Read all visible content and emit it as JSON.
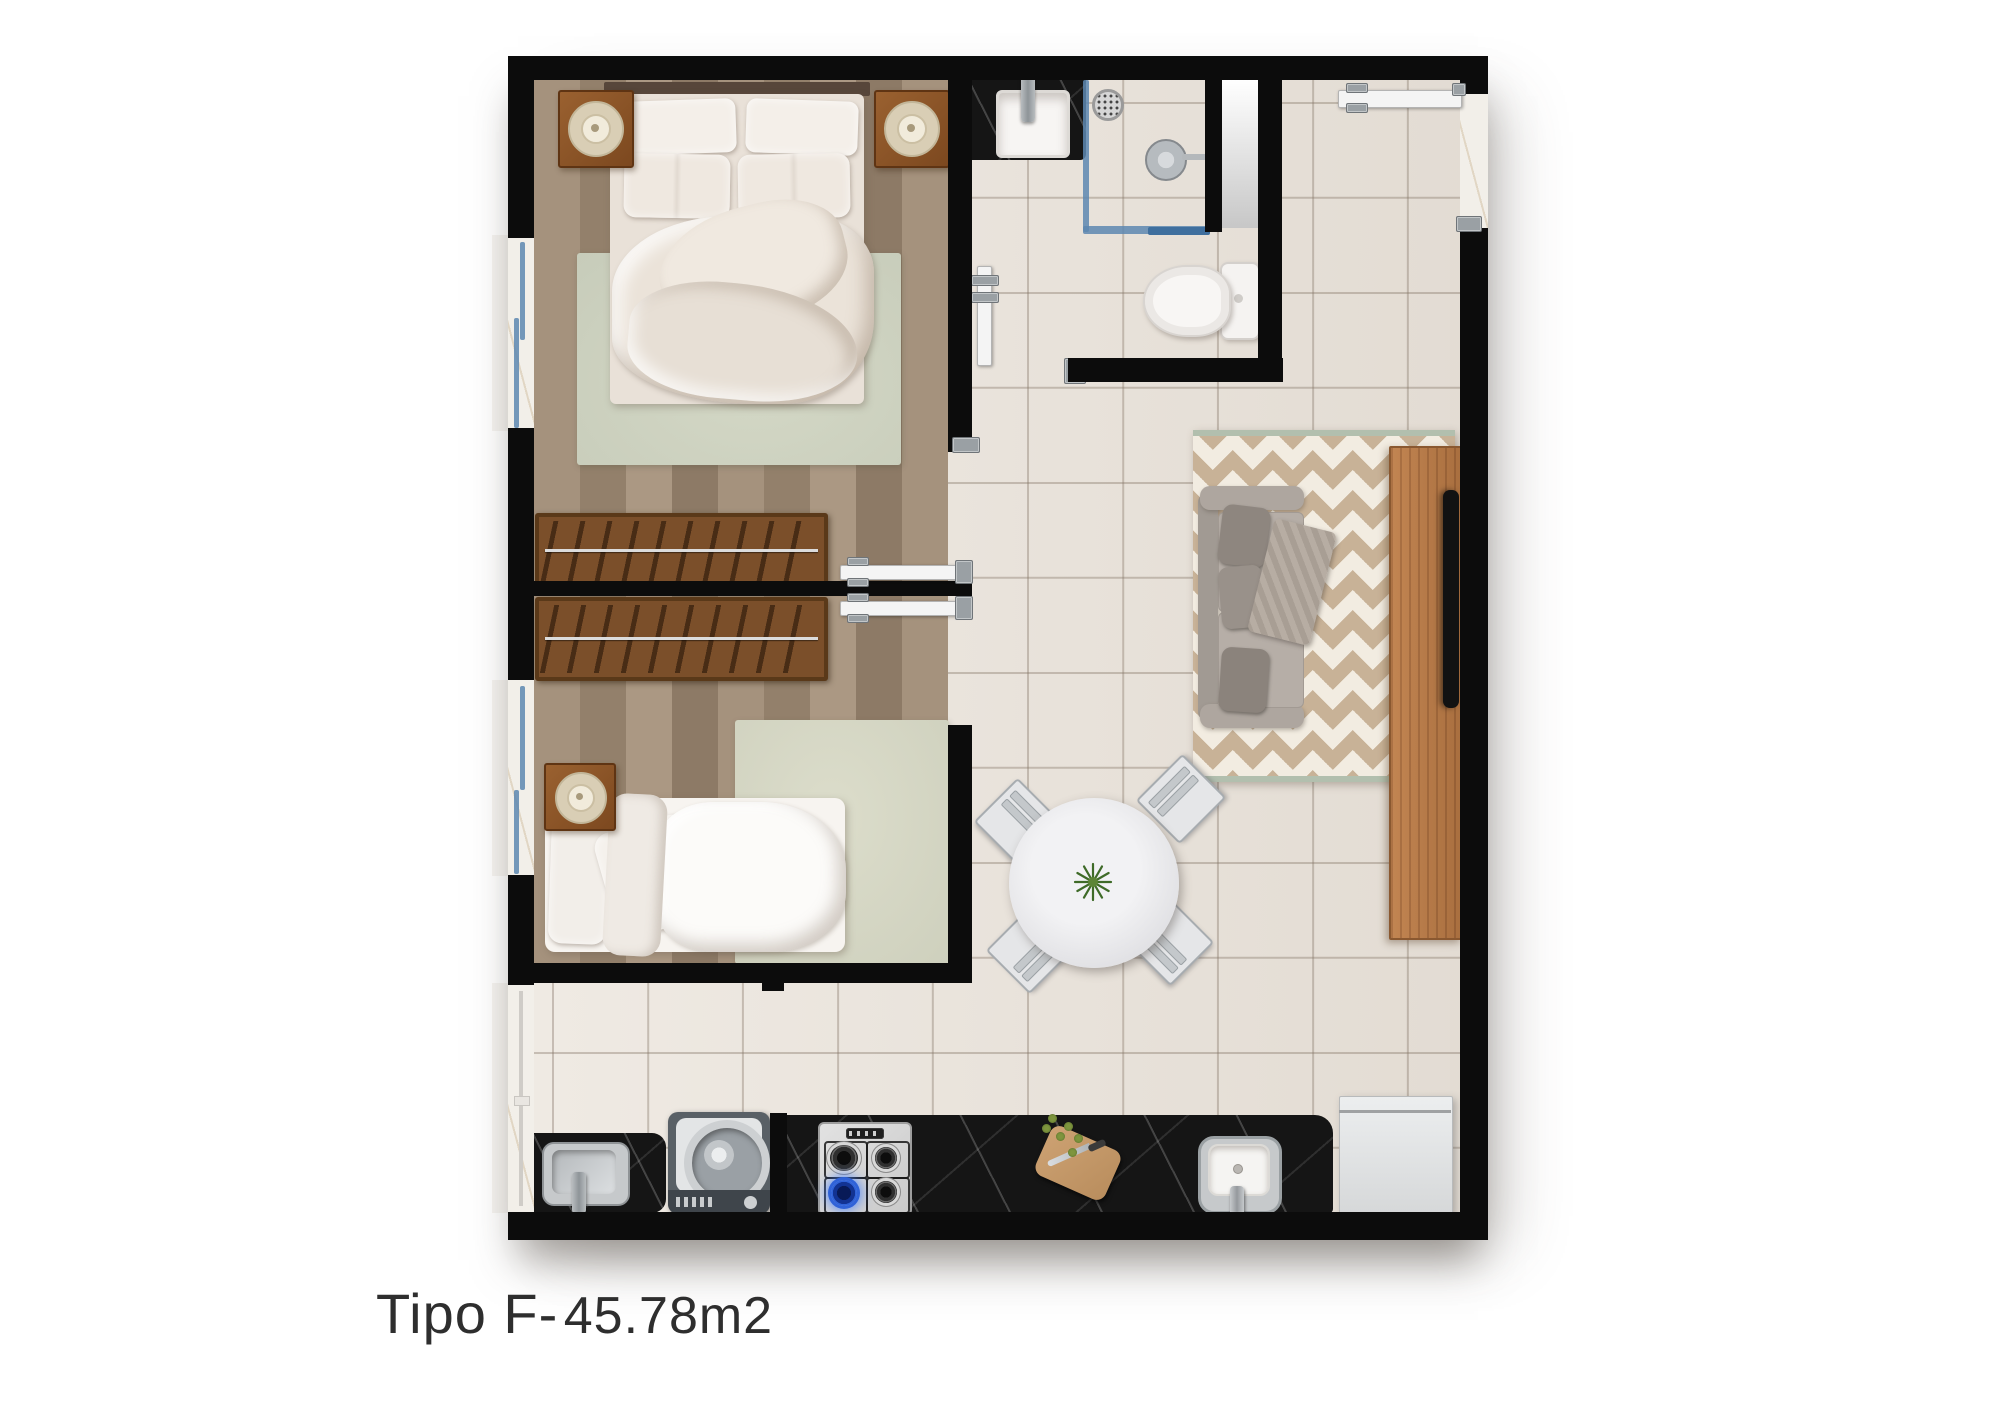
{
  "title": {
    "unit_type": "Tipo F-",
    "area": "45.78m2",
    "full_text": "Tipo F- 45.78m2"
  },
  "plan": {
    "kind": "apartment-floor-plan-top-view",
    "rooms": [
      {
        "name": "bedroom-1",
        "floor": "wood-plank",
        "furniture": [
          "double-bed",
          "nightstand-left",
          "nightstand-right",
          "lamp",
          "lamp",
          "area-rug",
          "wardrobe",
          "window",
          "door"
        ]
      },
      {
        "name": "bedroom-2",
        "floor": "wood-plank",
        "furniture": [
          "single-bed",
          "nightstand",
          "lamp",
          "area-rug",
          "wardrobe",
          "window",
          "door"
        ]
      },
      {
        "name": "bathroom",
        "floor": "ceramic-tile",
        "furniture": [
          "vanity-sink-black-marble",
          "shower-drain",
          "shower-head",
          "glass-shower-screen",
          "toilet",
          "door"
        ]
      },
      {
        "name": "living-dining",
        "floor": "ceramic-tile",
        "furniture": [
          "sofa",
          "chevron-rug",
          "tv-console",
          "tv",
          "round-dining-table",
          "dining-chair",
          "dining-chair",
          "dining-chair",
          "dining-chair",
          "center-plant",
          "entrance-door"
        ]
      },
      {
        "name": "kitchen-laundry",
        "floor": "ceramic-tile",
        "furniture": [
          "laundry-sink",
          "washing-machine",
          "gas-cooktop-4-burners",
          "cutting-board-with-knife",
          "kitchen-sink",
          "refrigerator",
          "black-marble-counter",
          "service-window"
        ]
      }
    ],
    "colors": {
      "wall": "#0c0c0c",
      "tile_floor": "#eae3da",
      "wood_floor": "#9c8873",
      "black_marble": "#151515",
      "white_marble": "#f2efe9",
      "chevron_rug_tan": "#c8b297",
      "chevron_rug_cream": "#f2ece1",
      "bedroom_rug_sage": "#ccd1c0",
      "sofa_gray": "#aca49d",
      "console_wood": "#b5784a",
      "glass_blue": "#5d87b0",
      "burner_flame_blue": "#2f62d8",
      "plant_green": "#3f6b28",
      "label_text": "#2e2e2e"
    }
  }
}
